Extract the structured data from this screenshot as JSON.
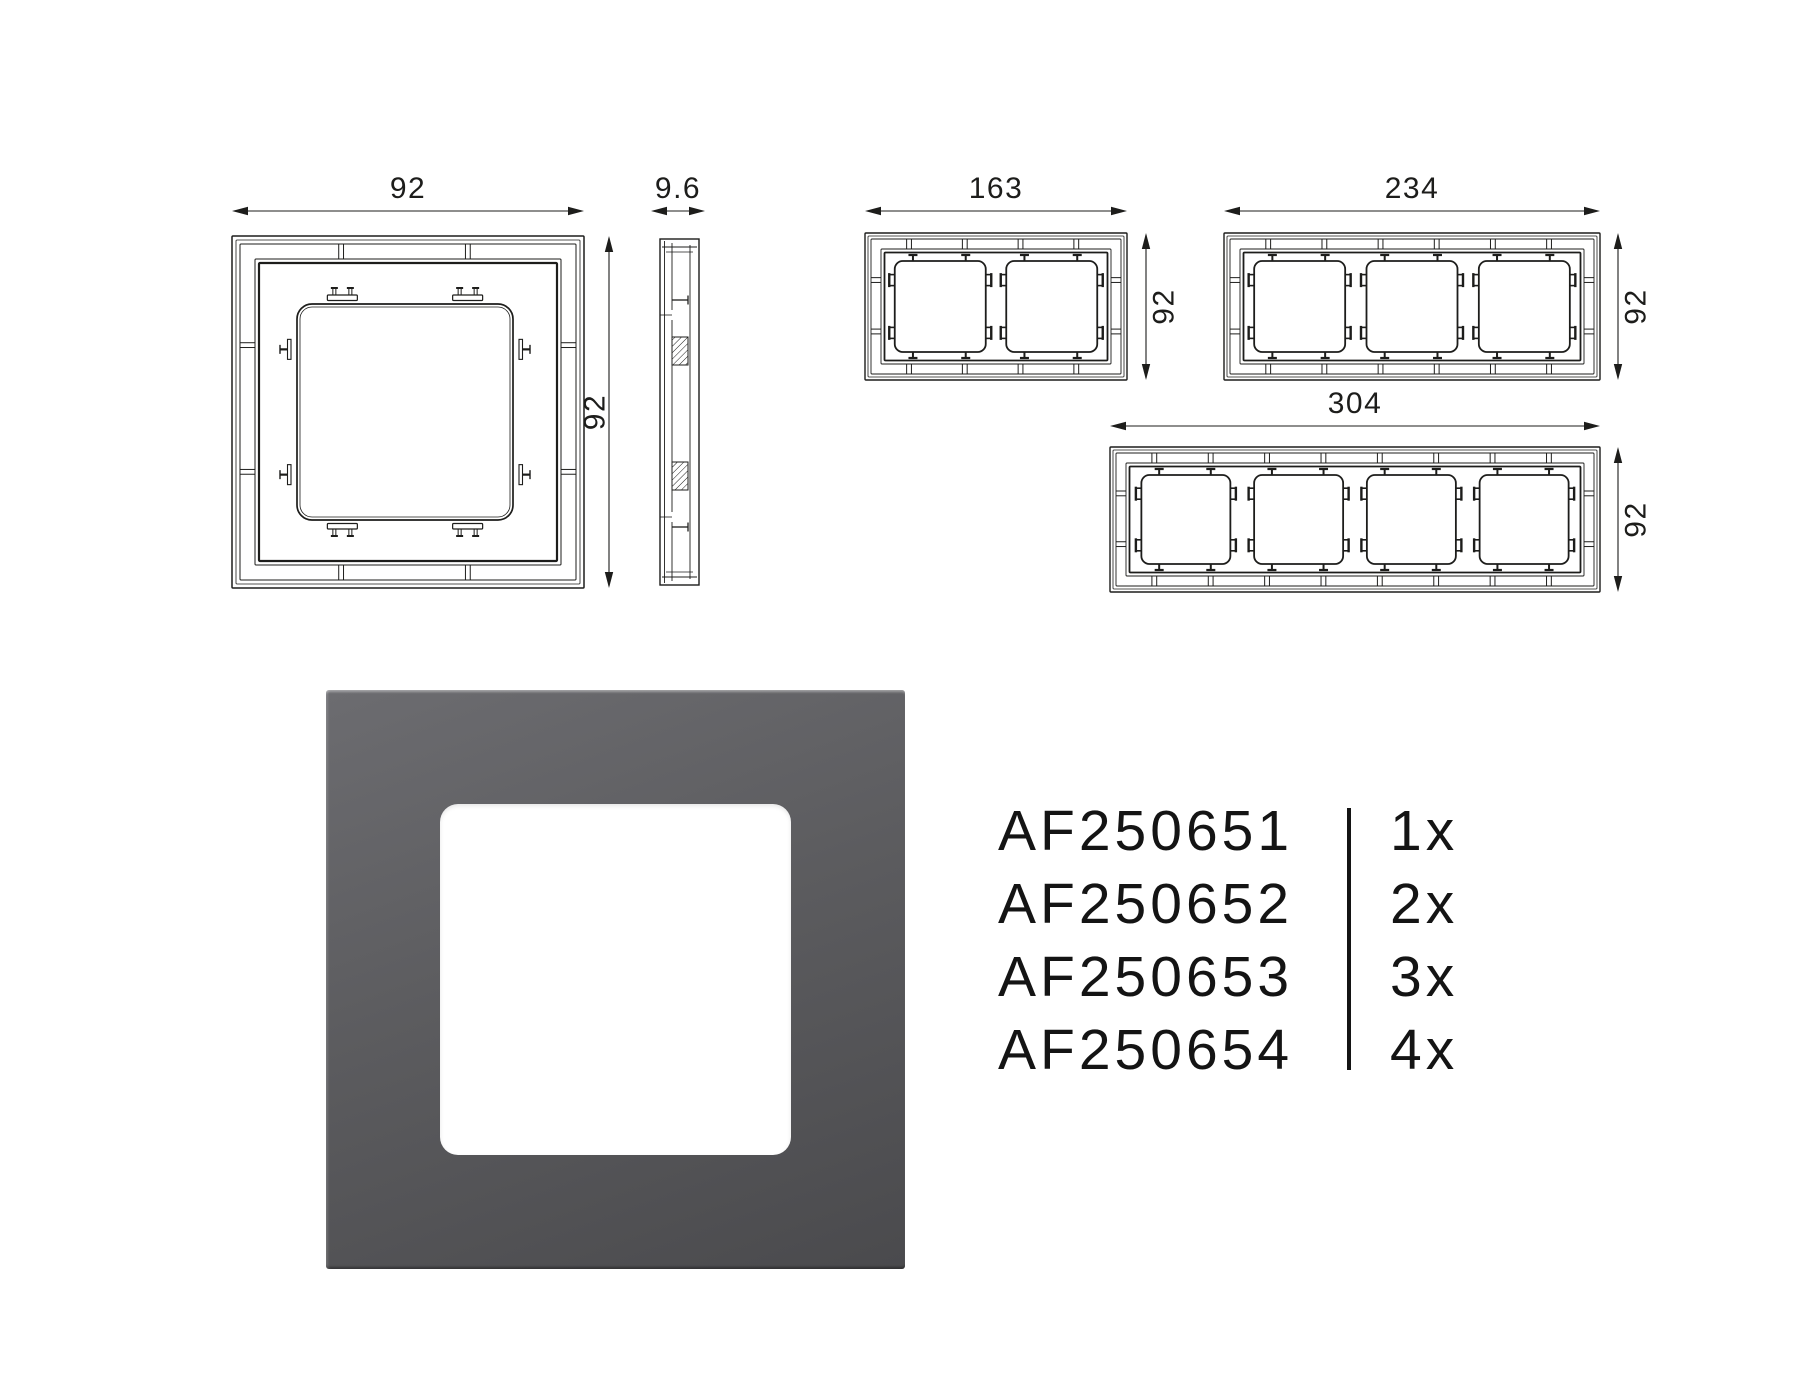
{
  "page": {
    "background": "#ffffff",
    "line_color": "#1d1d1b",
    "text_color": "#141414"
  },
  "drawings": {
    "single_front": {
      "width_label": "92",
      "height_label": "92",
      "gangs": 1
    },
    "single_side": {
      "thickness_label": "9.6"
    },
    "double_front": {
      "width_label": "163",
      "height_label": "92",
      "gangs": 2
    },
    "triple_front": {
      "width_label": "234",
      "height_label": "92",
      "gangs": 3
    },
    "quad_front": {
      "width_label": "304",
      "height_label": "92",
      "gangs": 4
    }
  },
  "product_render": {
    "frame_color_light": "#6c6c70",
    "frame_color_mid": "#5c5c5f",
    "frame_color_dark": "#4a4a4d",
    "window_color": "#ffffff"
  },
  "product_list": {
    "items": [
      {
        "part_number": "AF250651",
        "quantity": "1x"
      },
      {
        "part_number": "AF250652",
        "quantity": "2x"
      },
      {
        "part_number": "AF250653",
        "quantity": "3x"
      },
      {
        "part_number": "AF250654",
        "quantity": "4x"
      }
    ]
  }
}
